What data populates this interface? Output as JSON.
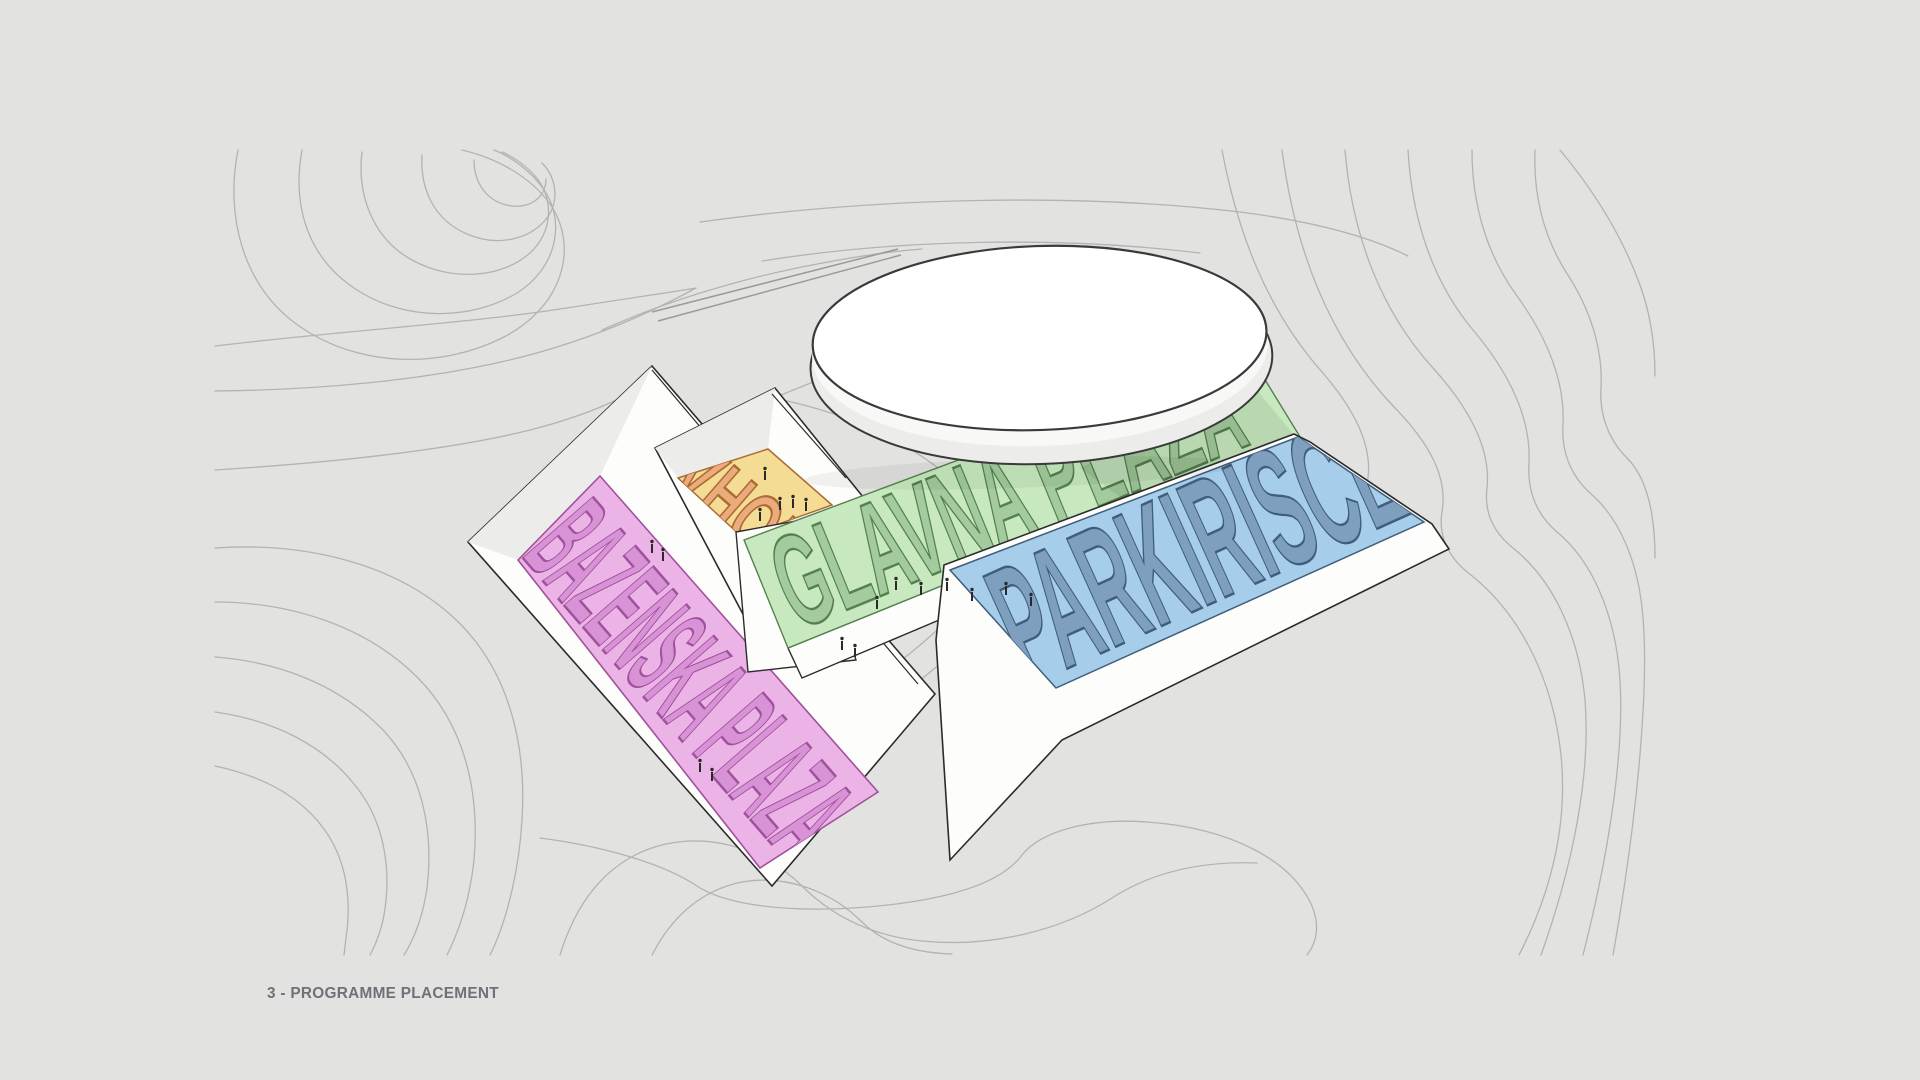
{
  "canvas": {
    "width": 1920,
    "height": 1080,
    "background": "#e2e2e1"
  },
  "caption": {
    "text": "3 - PROGRAMME PLACEMENT",
    "color": "#6e7176"
  },
  "terrain": {
    "contour_color": "#aeaeac",
    "outline_color": "#2b2b2b",
    "wall_fill": "#fdfdfc",
    "wall_shade": "#ececea",
    "ramp_color": "#9a9a98"
  },
  "building": {
    "top_fill": "#ffffff",
    "rim_fill": "#ececea",
    "rim_fill_light": "#f8f8f6",
    "outline": "#3a3a3a"
  },
  "zones": [
    {
      "id": "bazenska-plaza",
      "label": "BAZENSKA PLAZA",
      "floor_fill": "#ecb4e6",
      "letter_fill": "#d793d5",
      "letter_stroke": "#a0519c"
    },
    {
      "id": "vhod",
      "label": "VHOD",
      "floor_fill": "#f5dc95",
      "letter_fill": "#ecab7d",
      "letter_stroke": "#aa6c34"
    },
    {
      "id": "glavna-plaza",
      "label": "GLAVNA PLAZA",
      "floor_fill": "#c8e9bf",
      "letter_fill": "#a3cb9d",
      "letter_stroke": "#55814f"
    },
    {
      "id": "parkirisce",
      "label": "PARKIRISCE",
      "floor_fill": "#a6cde9",
      "letter_fill": "#7f9fbe",
      "letter_stroke": "#3f5e7c"
    }
  ],
  "figures": {
    "color": "#2a2a2a"
  }
}
